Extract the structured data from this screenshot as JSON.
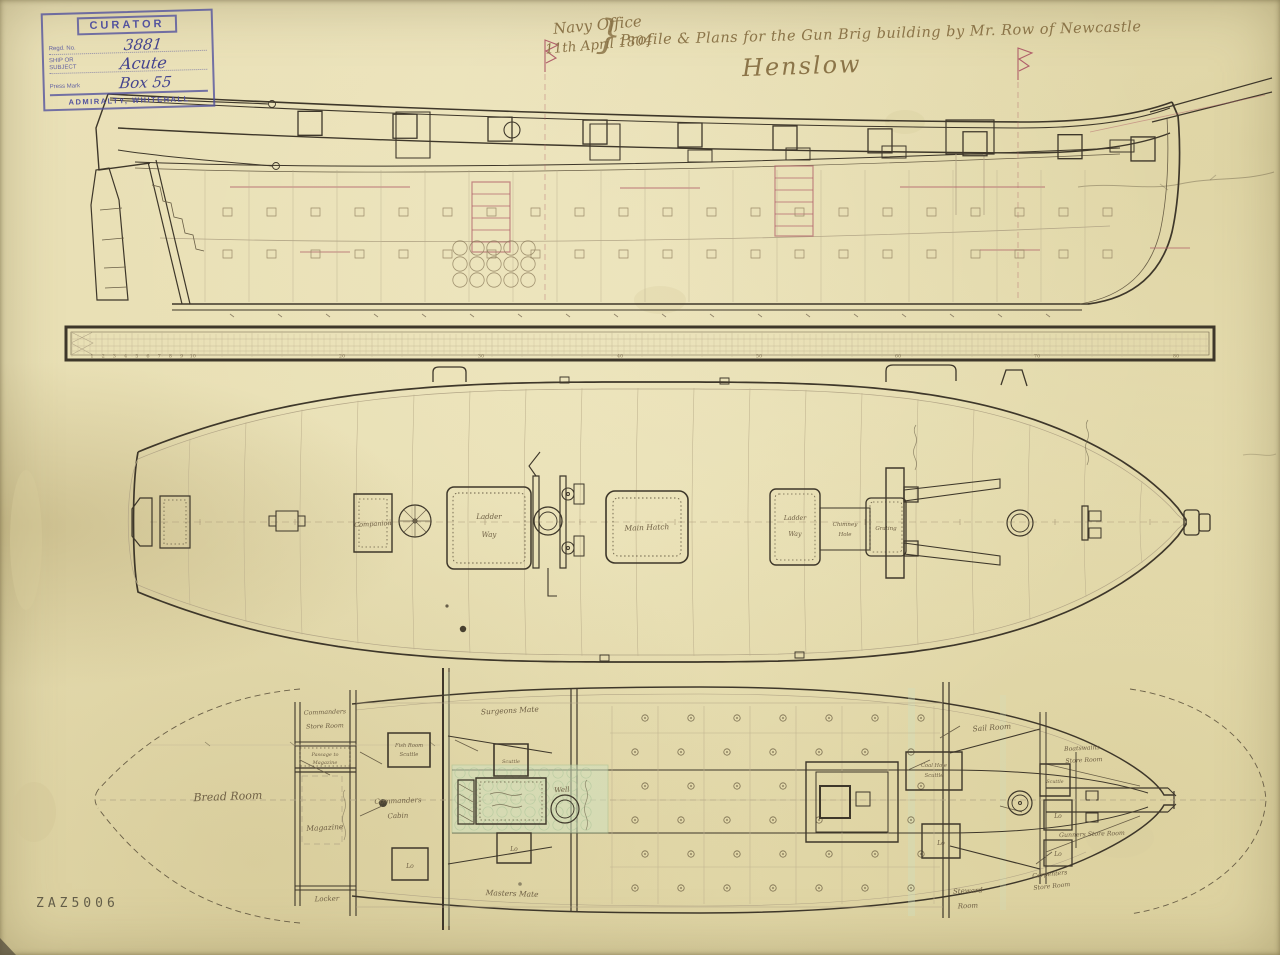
{
  "document": {
    "catalog_number": "ZAZ5006"
  },
  "stamp": {
    "curator": "CURATOR",
    "regd_label": "Regd. No.",
    "regd_value": "3881",
    "ship_label_1": "SHIP OR",
    "ship_label_2": "SUBJECT",
    "ship_value": "Acute",
    "press_label": "Press Mark",
    "press_value": "Box 55",
    "footer": "ADMIRALTY, WHITEHALL"
  },
  "header": {
    "office": "Navy Office",
    "date": "11th April 1804",
    "brace": "}",
    "title": "Profile & Plans for the Gun Brig building by Mr. Row of Newcastle",
    "signature": "Henslow"
  },
  "scale_bar": {
    "numbers": [
      "1",
      "2",
      "3",
      "4",
      "5",
      "6",
      "7",
      "8",
      "9",
      "10",
      "20",
      "30",
      "40",
      "50",
      "60",
      "70",
      "80"
    ]
  },
  "upper_deck": {
    "companion": "Companion",
    "ladder_way_l1": "Ladder",
    "ladder_way_l2": "Way",
    "main_hatch": "Main Hatch",
    "ladder_way2_l1": "Ladder",
    "ladder_way2_l2": "Way",
    "chimney_l1": "Chimney",
    "chimney_l2": "Hole",
    "grating": "Grating"
  },
  "lower_deck": {
    "bread_room": "Bread Room",
    "commanders_store_l1": "Commanders",
    "commanders_store_l2": "Store Room",
    "passage_l1": "Passage to",
    "passage_l2": "Magazine",
    "magazine": "Magazine",
    "locker": "Locker",
    "commanders_cabin_l1": "Commanders",
    "commanders_cabin_l2": "Cabin",
    "fish_room_l1": "Fish Room",
    "fish_room_l2": "Scuttle",
    "surgeons_mate": "Surgeons Mate",
    "masters_mate": "Masters Mate",
    "scuttle_aft": "Scuttle",
    "well": "Well",
    "locker_abbr": "Lo",
    "sail_room": "Sail Room",
    "coal_hole_l1": "Coal Hole",
    "coal_hole_l2": "Scuttle",
    "boatswains_l1": "Boatswains",
    "boatswains_l2": "Store Room",
    "scuttle_fore": "Scuttle",
    "gunners_store": "Gunners Store Room",
    "carpenters_l1": "Carpenters",
    "carpenters_l2": "Store Room",
    "steward_l1": "Steward",
    "steward_l2": "Room"
  },
  "colors": {
    "paper": "#e8dfb5",
    "ink": "#3e372a",
    "faded_ink": "#7c6d4e",
    "pencil": "#b3a687",
    "accent_red": "#b05f6a",
    "stamp_blue": "#4c4c9e",
    "wash_green": "#cfe0bf"
  }
}
